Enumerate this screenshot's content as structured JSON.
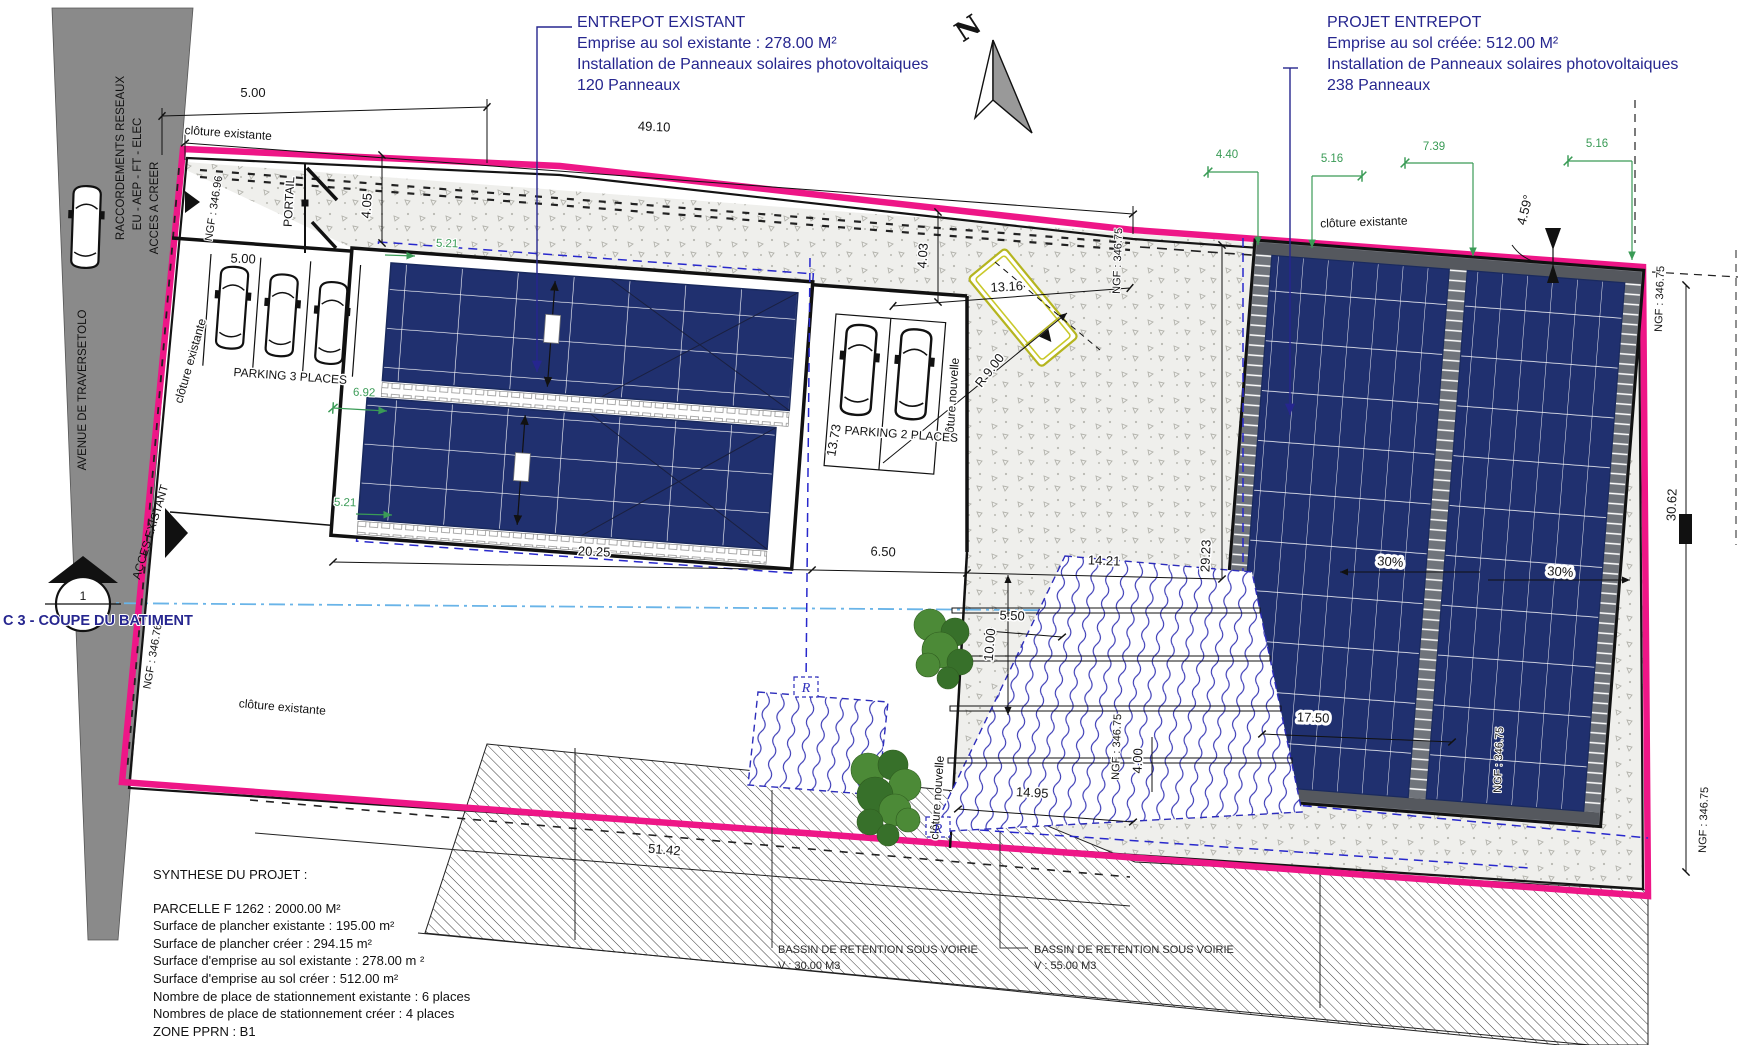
{
  "colors": {
    "boundary_pink": "#ee1687",
    "panel_blue": "#20306f",
    "dashed_blue": "#2828cc",
    "dim_green": "#3a9b56",
    "annotation_navy": "#26268f",
    "road_gray": "#8a8a8a",
    "section_line_blue": "#69b4e8"
  },
  "title_blocks": {
    "existing": {
      "x": 577,
      "y": 12,
      "lines": [
        "ENTREPOT EXISTANT",
        "Emprise au sol existante : 278.00  M²",
        "Installation de Panneaux solaires photovoltaiques",
        "120 Panneaux"
      ]
    },
    "project": {
      "x": 1327,
      "y": 12,
      "lines": [
        "PROJET ENTREPOT",
        "Emprise au sol créée: 512.00  M²",
        "Installation de Panneaux solaires photovoltaiques",
        "238 Panneaux"
      ]
    }
  },
  "synthesis": {
    "x": 153,
    "y": 866,
    "title": "SYNTHESE DU PROJET :",
    "lines": [
      "PARCELLE F 1262 : 2000.00 M²",
      "Surface de plancher existante : 195.00 m²",
      "Surface de plancher créer : 294.15 m²",
      "Surface d'emprise au sol existante : 278.00 m ²",
      "Surface d'emprise au sol créer : 512.00 m²",
      "Nombre de place de stationnement existante : 6 places",
      "Nombres de place de stationnement créer : 4 places",
      "ZONE PPRN : B1"
    ]
  },
  "labels": [
    {
      "t": "5.00",
      "x": 253,
      "y": 97,
      "c": "dim"
    },
    {
      "t": "49.10",
      "x": 654,
      "y": 131,
      "r": 2,
      "c": "dim"
    },
    {
      "t": "5.00",
      "x": 243,
      "y": 263,
      "r": 2,
      "c": "dim"
    },
    {
      "t": "4.05",
      "x": 371,
      "y": 206,
      "r": -86,
      "c": "dim"
    },
    {
      "t": "4.03",
      "x": 927,
      "y": 256,
      "r": -86,
      "c": "dim"
    },
    {
      "t": "13.16",
      "x": 1007,
      "y": 291,
      "r": -3,
      "c": "dim"
    },
    {
      "t": "R 9.00",
      "x": 993,
      "y": 373,
      "r": -52,
      "c": "dim"
    },
    {
      "t": "13.73",
      "x": 838,
      "y": 441,
      "r": -80,
      "c": "dim"
    },
    {
      "t": "20.25",
      "x": 594,
      "y": 556,
      "r": 2,
      "c": "dim"
    },
    {
      "t": "6.50",
      "x": 883,
      "y": 556,
      "r": 2,
      "c": "dim"
    },
    {
      "t": "14.21",
      "x": 1104,
      "y": 565,
      "r": 2,
      "c": "dim"
    },
    {
      "t": "29.23",
      "x": 1210,
      "y": 556,
      "r": -88,
      "c": "dim"
    },
    {
      "t": "5.50",
      "x": 1012,
      "y": 620,
      "r": 2,
      "c": "dim"
    },
    {
      "t": "10.00",
      "x": 994,
      "y": 645,
      "r": -85,
      "c": "dim"
    },
    {
      "t": "14.95",
      "x": 1032,
      "y": 797,
      "r": 3,
      "c": "dim"
    },
    {
      "t": "51.42",
      "x": 664,
      "y": 854,
      "r": 5,
      "c": "dim"
    },
    {
      "t": "17.50",
      "x": 1313,
      "y": 722,
      "r": 2,
      "c": "dim box"
    },
    {
      "t": "30.62",
      "x": 1676,
      "y": 505,
      "r": -88,
      "c": "dim"
    },
    {
      "t": "4.59°",
      "x": 1529,
      "y": 211,
      "r": -76,
      "c": "dim"
    },
    {
      "t": "4.00",
      "x": 1142,
      "y": 761,
      "r": -88,
      "c": "dim"
    },
    {
      "t": "30%",
      "x": 1390,
      "y": 566,
      "r": 4,
      "c": "dim box"
    },
    {
      "t": "30%",
      "x": 1560,
      "y": 576,
      "r": 4,
      "c": "dim box"
    },
    {
      "t": "4.40",
      "x": 1227,
      "y": 158,
      "c": "dimg"
    },
    {
      "t": "5.16",
      "x": 1332,
      "y": 162,
      "c": "dimg"
    },
    {
      "t": "7.39",
      "x": 1434,
      "y": 150,
      "c": "dimg"
    },
    {
      "t": "5.16",
      "x": 1597,
      "y": 147,
      "c": "dimg"
    },
    {
      "t": "5.21",
      "x": 447,
      "y": 247,
      "r": 2,
      "c": "dimg"
    },
    {
      "t": "5.21",
      "x": 345,
      "y": 506,
      "r": 2,
      "c": "dimg"
    },
    {
      "t": "6.92",
      "x": 364,
      "y": 396,
      "r": 2,
      "c": "dimg"
    },
    {
      "t": "clôture existante",
      "x": 228,
      "y": 137,
      "r": 4,
      "c": "site"
    },
    {
      "t": "clôture existante",
      "x": 194,
      "y": 362,
      "r": -74,
      "c": "site"
    },
    {
      "t": "clôture existante",
      "x": 1364,
      "y": 226,
      "r": -2,
      "c": "site"
    },
    {
      "t": "clôture existante",
      "x": 282,
      "y": 711,
      "r": 5,
      "c": "site"
    },
    {
      "t": "clôture nouvelle",
      "x": 956,
      "y": 400,
      "r": -86,
      "c": "site"
    },
    {
      "t": "clôture nouvelle",
      "x": 941,
      "y": 798,
      "r": -86,
      "c": "site"
    },
    {
      "t": "PORTAIL",
      "x": 293,
      "y": 202,
      "r": -87,
      "c": "site"
    },
    {
      "t": "PARKING 3 PLACES",
      "x": 290,
      "y": 380,
      "r": 4,
      "c": "site"
    },
    {
      "t": "PARKING 2 PLACES",
      "x": 901,
      "y": 438,
      "r": 4,
      "c": "site"
    },
    {
      "t": "RACCORDEMENTS RESEAUX",
      "x": 124,
      "y": 158,
      "r": -90,
      "c": "road"
    },
    {
      "t": "EU - AEP - FT - ELEC",
      "x": 141,
      "y": 174,
      "r": -90,
      "c": "road"
    },
    {
      "t": "ACCES A CREER",
      "x": 158,
      "y": 208,
      "r": -90,
      "c": "road"
    },
    {
      "t": "AVENUE DE TRAVERSETOLO",
      "x": 86,
      "y": 390,
      "r": -90,
      "c": "road"
    },
    {
      "t": "ACCES EXISTANT",
      "x": 154,
      "y": 533,
      "r": -73,
      "c": "road"
    },
    {
      "t": "NGF : 346.96",
      "x": 217,
      "y": 209,
      "r": -81,
      "c": "ngf"
    },
    {
      "t": "NGF : 346.76",
      "x": 156,
      "y": 657,
      "r": -80,
      "c": "ngf"
    },
    {
      "t": "NGF : 346.75",
      "x": 1121,
      "y": 261,
      "r": -88,
      "c": "ngf"
    },
    {
      "t": "NGF : 346.75",
      "x": 1663,
      "y": 299,
      "r": -88,
      "c": "ngf"
    },
    {
      "t": "NGF : 346.75",
      "x": 1120,
      "y": 747,
      "r": -88,
      "c": "ngf"
    },
    {
      "t": "NGF : 346.75",
      "x": 1502,
      "y": 760,
      "r": -88,
      "c": "ngf"
    },
    {
      "t": "NGF : 346.75",
      "x": 1707,
      "y": 820,
      "r": -88,
      "c": "ngf"
    },
    {
      "t": "BASSIN DE RETENTION SOUS VOIRIE",
      "x": 778,
      "y": 953,
      "c": "sm",
      "a": "s"
    },
    {
      "t": "V : 30.00 M3",
      "x": 778,
      "y": 969,
      "c": "sm",
      "a": "s"
    },
    {
      "t": "BASSIN DE RETENTION SOUS VOIRIE",
      "x": 1034,
      "y": 953,
      "c": "sm",
      "a": "s"
    },
    {
      "t": "V : 55.00 M3",
      "x": 1034,
      "y": 969,
      "c": "sm",
      "a": "s"
    },
    {
      "t": "C 3 - COUPE DU BATIMENT",
      "x": 3,
      "y": 625,
      "c": "c3",
      "a": "s"
    },
    {
      "t": "1",
      "x": 83,
      "y": 600,
      "c": "site"
    },
    {
      "t": "N",
      "x": 973,
      "y": 36,
      "r": -33,
      "c": "north"
    },
    {
      "t": "R",
      "x": 806,
      "y": 692,
      "c": "rlbl"
    },
    {
      "t": "R",
      "x": 938,
      "y": 833,
      "c": "rlbl"
    }
  ]
}
